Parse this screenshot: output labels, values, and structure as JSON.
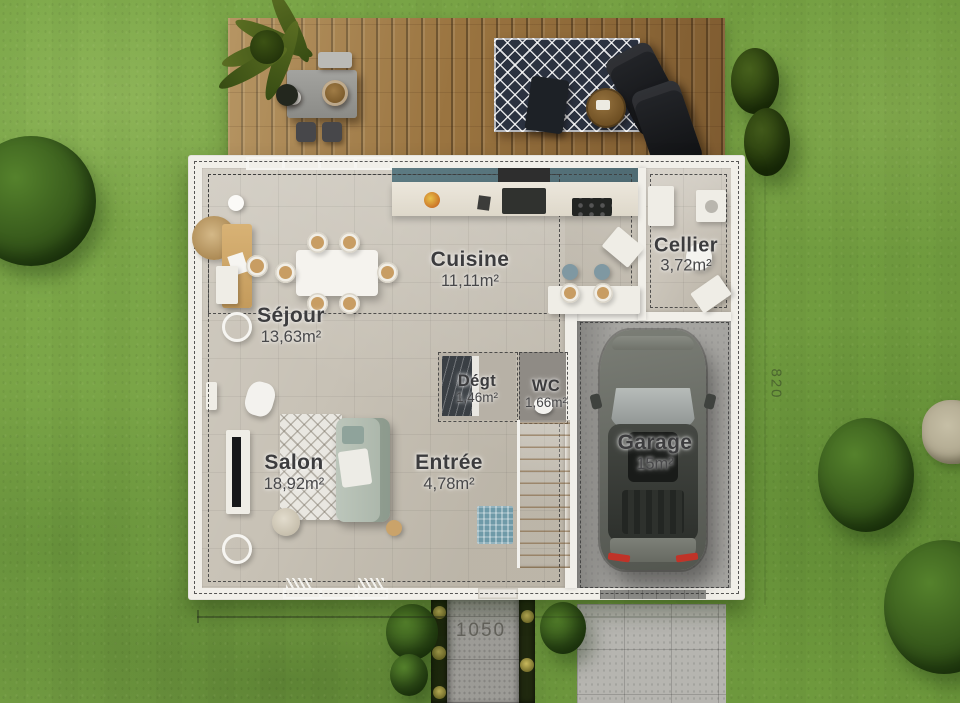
{
  "rooms": [
    {
      "id": "sejour",
      "label": "Séjour",
      "area": "13,63m²"
    },
    {
      "id": "salon",
      "label": "Salon",
      "area": "18,92m²"
    },
    {
      "id": "cuisine",
      "label": "Cuisine",
      "area": "11,11m²"
    },
    {
      "id": "cellier",
      "label": "Cellier",
      "area": "3,72m²"
    },
    {
      "id": "degagement",
      "label": "Dégt",
      "area": "1,46m²"
    },
    {
      "id": "wc",
      "label": "WC",
      "area": "1,66m²"
    },
    {
      "id": "entree",
      "label": "Entrée",
      "area": "4,78m²"
    },
    {
      "id": "garage",
      "label": "Garage",
      "area": "15m²"
    }
  ],
  "dimensions": {
    "front_width": "1050",
    "right_depth": "820"
  },
  "colors": {
    "grass": "#76a441",
    "deck_wood": "#9a7440",
    "wall": "#f1efe9",
    "living_floor": "#c8c2b6",
    "garage_floor": "#a6a5a1",
    "kitchen_wall": "#5d7b83",
    "label_text": "#3c3c3e",
    "dimension_text": "#5c5b54"
  }
}
